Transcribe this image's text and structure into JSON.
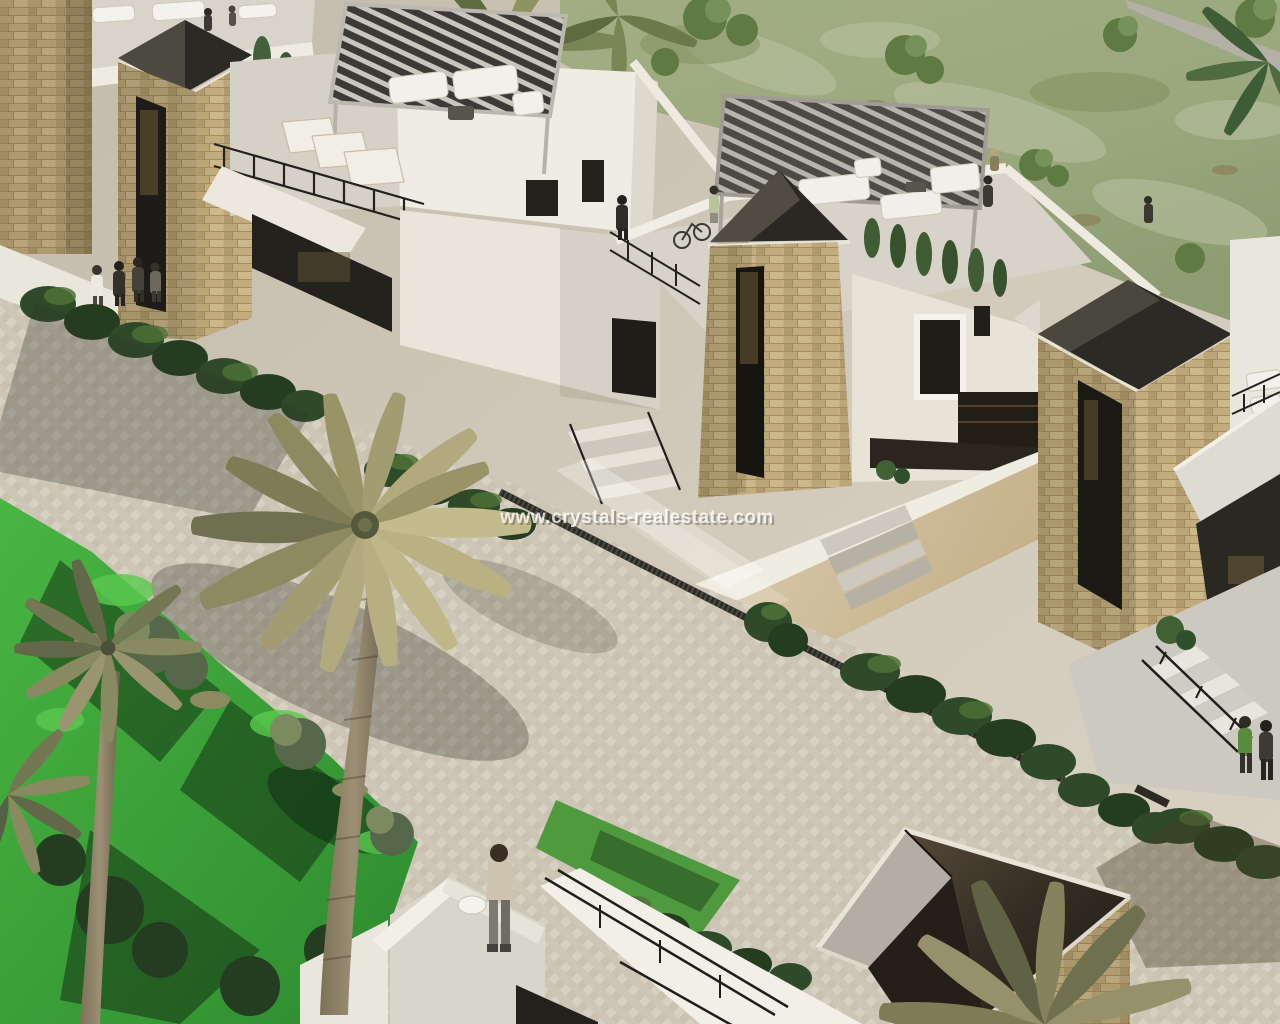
{
  "title": "Aerial 3D render of a modern villa development",
  "watermark": {
    "text": "www.crystals-realestate.com",
    "color": "#ffffff",
    "opacity": 0.75
  },
  "palette": {
    "pavement": "#d2cbbc",
    "pavement_shadow": "#a89f8d",
    "garden_grass": "#3fae3c",
    "garden_shadow": "#1f3d1f",
    "lawn_sage": "#9aa87e",
    "lawn_dry_patch": "#bcc2a3",
    "stone_cladding": "#c6b07f",
    "stone_mortar": "#97835c",
    "white_wall": "#efece3",
    "wall_shade": "#d6d2c6",
    "dark_glass": "#26221a",
    "pyramid_reflection": "#b2aea3",
    "pergola_slats_black": "#3b3a36",
    "pergola_slats_grey": "#4b4a45",
    "railing": "#201f1c",
    "hedge": "#33502b",
    "palm_frond_khaki": "#b2aa7e",
    "palm_frond_olive": "#6f7050",
    "palm_trunk": "#93866c"
  },
  "scene": {
    "description": "Aerial view of white modern villas with stone-clad lift towers topped by dark pyramid caps, rooftop terraces with slatted pergolas and white lounge furniture, a palm garden with bright lawn, a paved promenade with hedges and black railings, and a stone annex with a dark glass pyramid skylight",
    "buildings": [
      "left villa with black-slat rooftop pergola and sun loungers",
      "centre villa with grey-slat rooftop pergola and outdoor lounge",
      "stone tower with dark pyramid cap (left)",
      "stone tower with dark pyramid cap (centre)",
      "stone tower with dark pyramid cap (right)",
      "stone annex with glass pyramid skylight (bottom right)"
    ]
  }
}
